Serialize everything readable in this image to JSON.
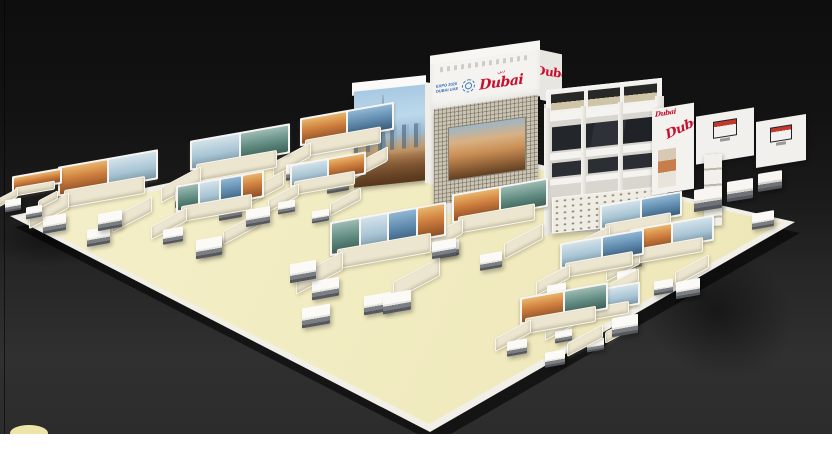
{
  "scene": {
    "description": "3D visualisation of a Dubai tourism exhibition stand: cream platform with white lounge seating pods, picture panels, a hero cube with the Dubai skyline, a branded header structure with lattice screen, an open pergola hospitality area and a wall run with mounted displays",
    "backdrop_top_color": "#101010",
    "backdrop_bottom_color": "#2f2f2f",
    "floor_color": "#f2ecc2",
    "platform_rim_color": "#f1efe8",
    "sofa_color": "#ece6d0",
    "accent_red": "#c8102e",
    "accent_blue": "#2f6db5"
  },
  "branding": {
    "expo_wordmark_line1": "EXPO 2020",
    "expo_wordmark_line2": "DUBAI UAE",
    "emblem_icon": "expo-2020-emblem",
    "dubai_script": "Dubai",
    "dubai_arabic": "دبي"
  },
  "panels": {
    "variants": [
      "sunset-orange-cityscape",
      "pale-blue-cityscape",
      "blue-tower-cityscape",
      "teal-green-cityscape"
    ]
  }
}
